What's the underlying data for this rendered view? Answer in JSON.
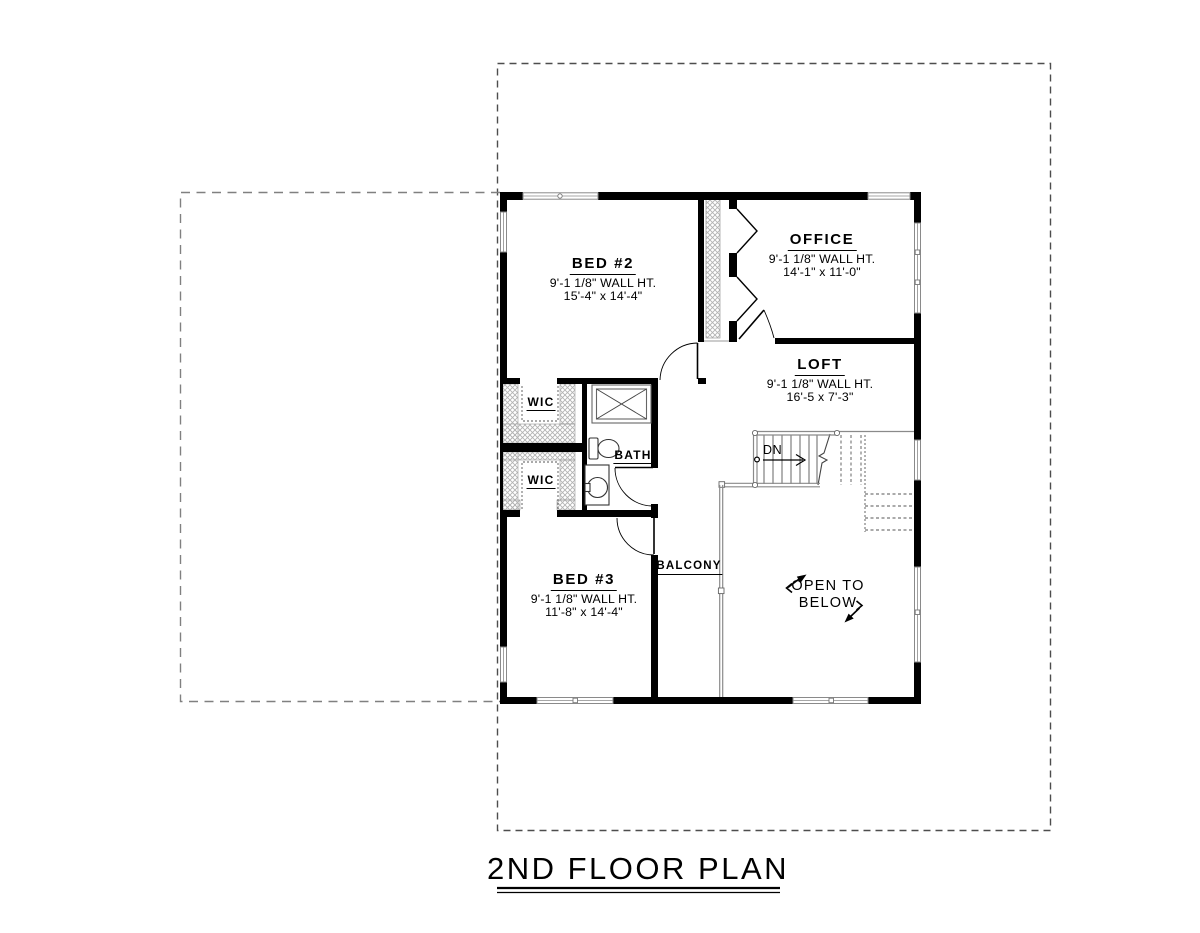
{
  "title": {
    "text": "2ND FLOOR PLAN"
  },
  "rooms": {
    "bed2": {
      "name": "BED #2",
      "wall_ht": "9'-1 1/8\" WALL HT.",
      "dims": "15'-4\" x 14'-4\""
    },
    "office": {
      "name": "OFFICE",
      "wall_ht": "9'-1 1/8\" WALL HT.",
      "dims": "14'-1\" x 11'-0\""
    },
    "loft": {
      "name": "LOFT",
      "wall_ht": "9'-1 1/8\" WALL HT.",
      "dims": "16'-5 x 7'-3\""
    },
    "bed3": {
      "name": "BED #3",
      "wall_ht": "9'-1 1/8\" WALL HT.",
      "dims": "11'-8\" x 14'-4\""
    },
    "wic_upper": {
      "name": "WIC"
    },
    "wic_lower": {
      "name": "WIC"
    },
    "bath": {
      "name": "BATH"
    },
    "balcony": {
      "name": "BALCONY"
    }
  },
  "annotations": {
    "stairs_down": "DN",
    "open_to_below_line1": "OPEN TO",
    "open_to_below_line2": "BELOW"
  },
  "colors": {
    "wall": "#000000",
    "window_frame": "#8a8a8a",
    "closet_hatch": "#b3b3b3",
    "roof_outline_dash": "#4d4d4d",
    "lower_roof_dash": "#808080",
    "background": "#ffffff"
  }
}
